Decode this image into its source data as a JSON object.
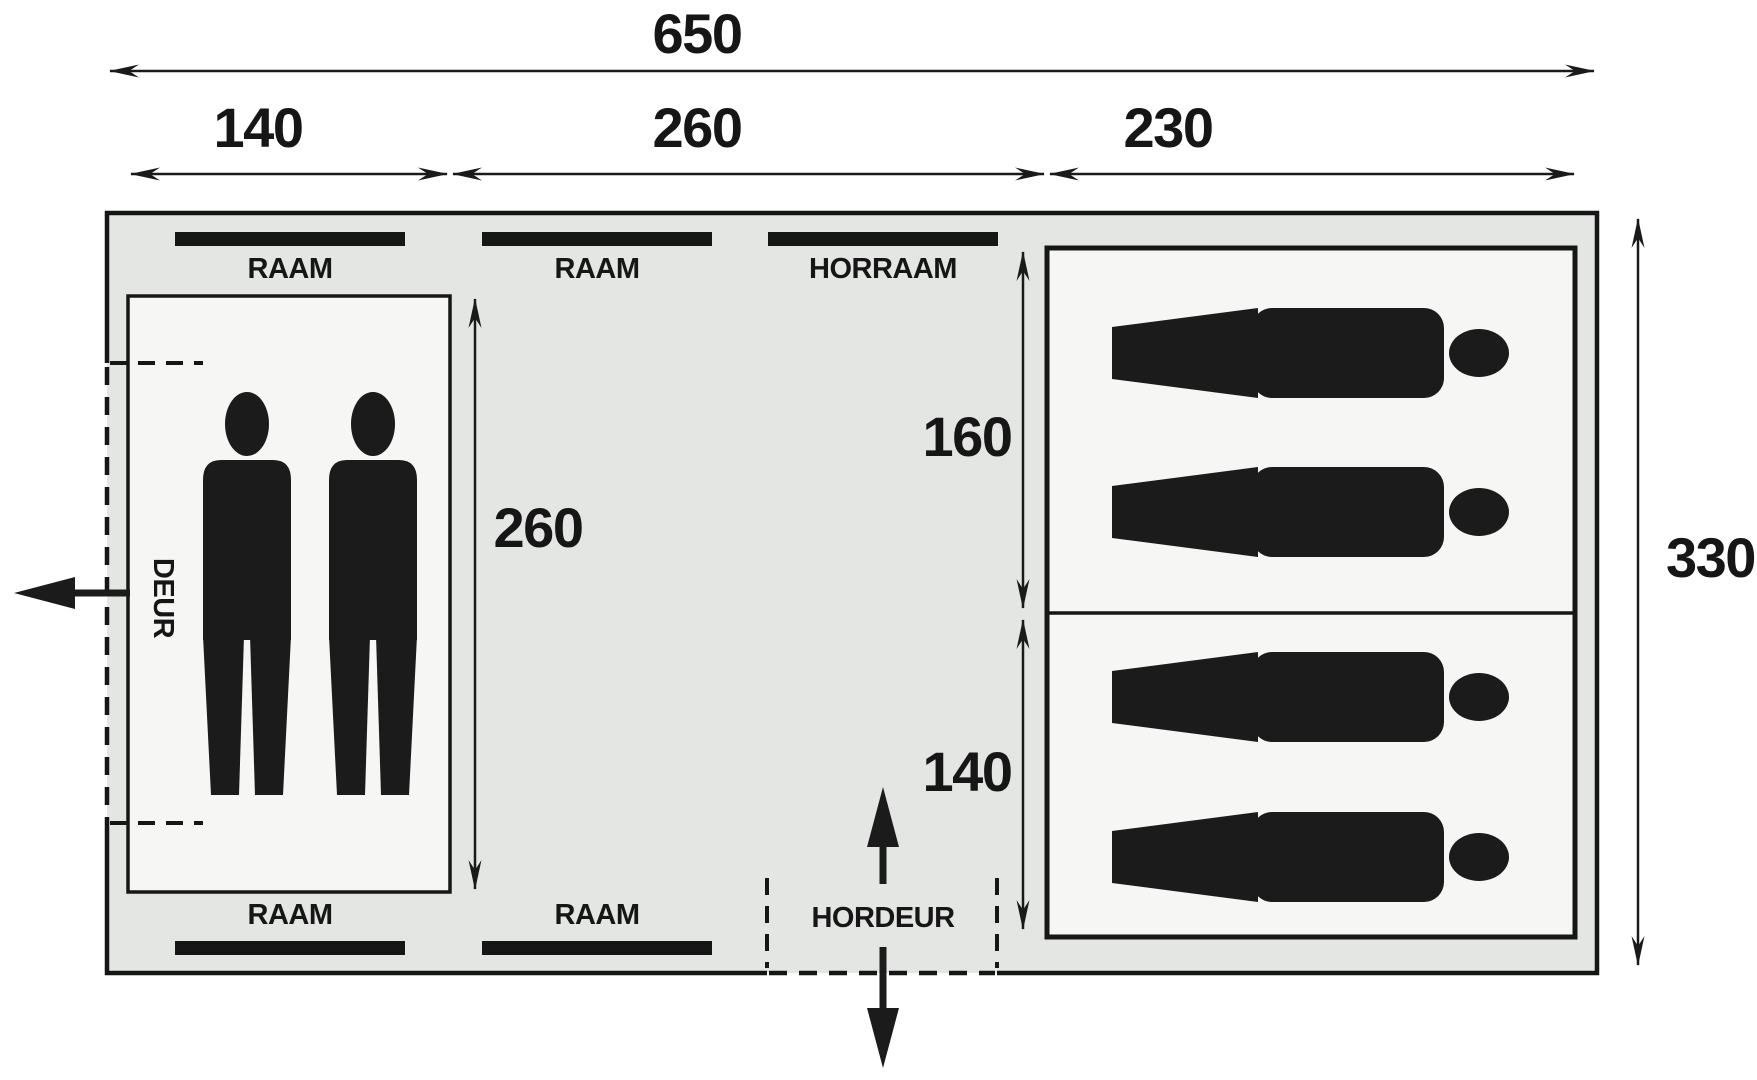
{
  "figure": {
    "title": "tent floor plan diagram",
    "dims": {
      "overall_width": "650",
      "left_section": "140",
      "middle_section": "260",
      "right_section": "230",
      "overall_depth": "330",
      "inner_room_depth": "260",
      "sleep_cabin_top": "160",
      "sleep_cabin_bottom": "140"
    },
    "windows_top": [
      {
        "label": "RAAM"
      },
      {
        "label": "RAAM"
      },
      {
        "label": "HORRAAM"
      }
    ],
    "windows_bottom": [
      {
        "label": "RAAM"
      },
      {
        "label": "RAAM"
      }
    ],
    "doors": {
      "side_door": "DEUR",
      "mesh_door": "HORDEUR"
    },
    "occupants": {
      "standing_figures": 2,
      "sleeping_places": 4
    },
    "colors": {
      "tent_fill": "#e4e6e4",
      "room_fill": "#f6f7f5",
      "line": "#161616",
      "background": "#ffffff"
    }
  }
}
